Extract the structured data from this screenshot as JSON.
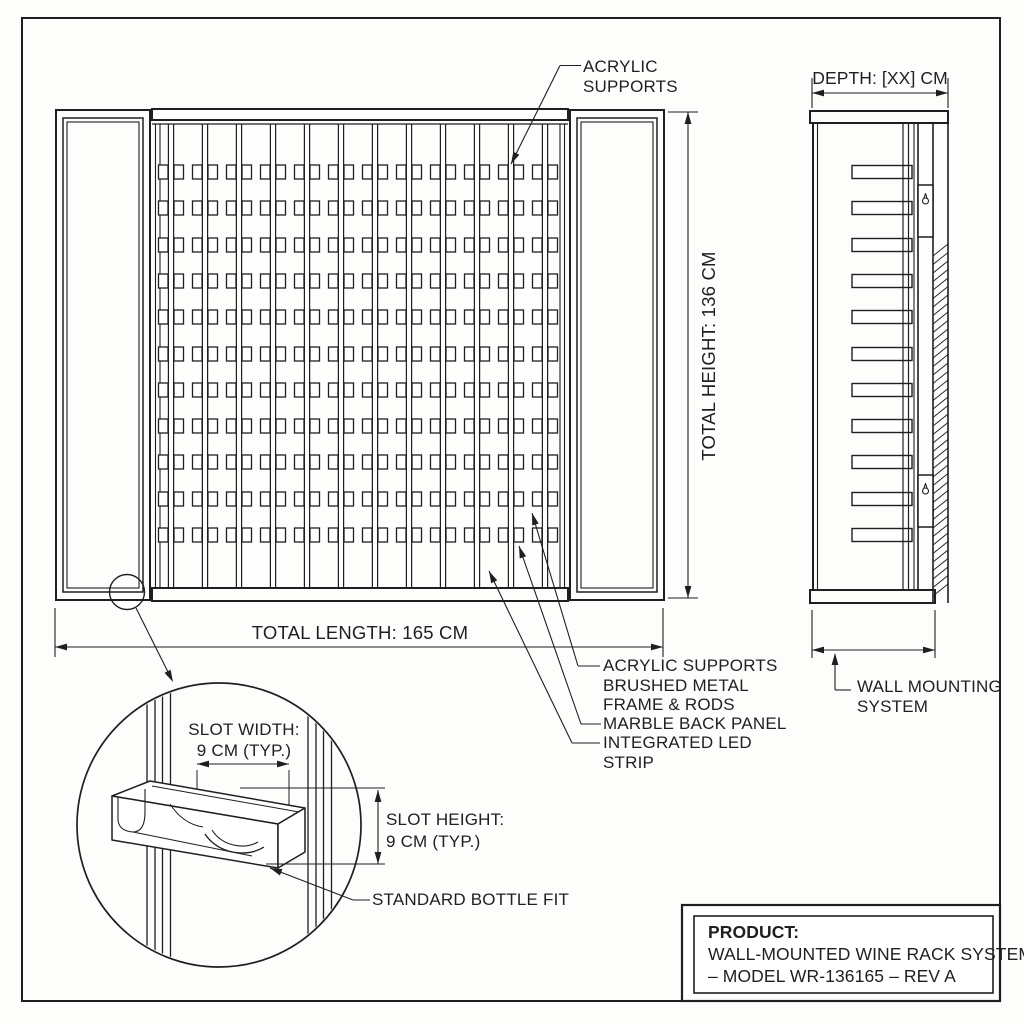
{
  "labels": {
    "acrylic_top_1": "ACRYLIC",
    "acrylic_top_2": "SUPPORTS",
    "callout_1": "ACRYLIC SUPPORTS",
    "callout_2a": "BRUSHED METAL",
    "callout_2b": "FRAME & RODS",
    "callout_3": "MARBLE BACK PANEL",
    "callout_4a": "INTEGRATED LED",
    "callout_4b": "STRIP",
    "wall_mount_1": "WALL MOUNTING",
    "wall_mount_2": "SYSTEM",
    "bottle_fit": "STANDARD BOTTLE FIT"
  },
  "dimensions": {
    "total_length": "TOTAL LENGTH: 165 CM",
    "total_height": "TOTAL HEIGHT: 136 CM",
    "depth": "DEPTH: [XX] CM",
    "slot_width_label": "SLOT WIDTH:",
    "slot_width_value": "9 CM (TYP.)",
    "slot_height_label": "SLOT HEIGHT:",
    "slot_height_value": "9 CM (TYP.)"
  },
  "title_block": {
    "heading": "PRODUCT:",
    "line1": "WALL-MOUNTED WINE RACK SYSTEM",
    "line2": "– MODEL WR-136165 – REV A"
  },
  "structure": {
    "rack_columns": 12,
    "rack_rows": 11,
    "side_view_shelves": 11,
    "wall_brackets": 2
  },
  "style": {
    "ink": "#1f1f1f",
    "paper": "#ffffff"
  }
}
